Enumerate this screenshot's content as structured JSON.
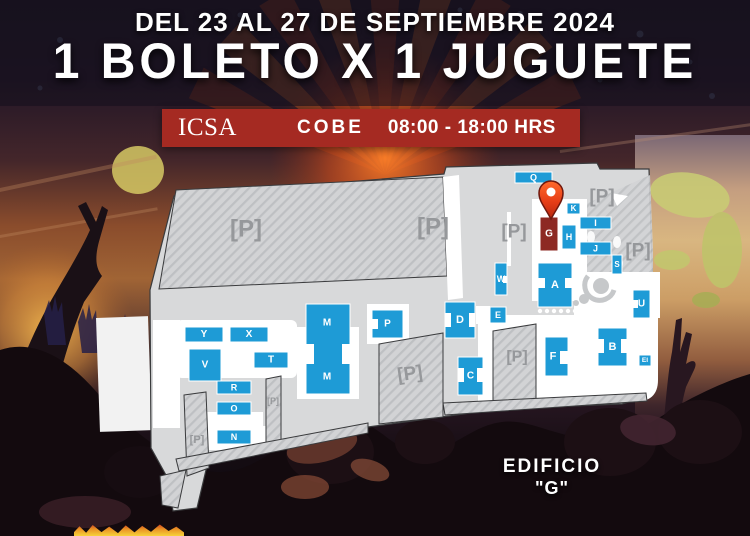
{
  "header": {
    "date_line": "DEL 23 AL 27 DE SEPTIEMBRE 2024",
    "promo_line": "1 BOLETO X 1 JUGUETE"
  },
  "banner": {
    "org": "ICSA",
    "dept": "COBE",
    "hours": "08:00 - 18:00 HRS",
    "bg_color": "#a52a22"
  },
  "callout": {
    "line1": "EDIFICIO",
    "line2": "\"G\""
  },
  "map": {
    "colors": {
      "land": "#d8d9da",
      "building": "#1e9bd6",
      "highlight": "#8d2923",
      "outline": "#3a3b3d",
      "parking_text": "#96989b",
      "pin": "#e8481f",
      "pin_dark": "#70180d"
    },
    "parking_symbol": "[P]",
    "highlighted_building": "G",
    "pin": {
      "x": 551,
      "y": 219
    },
    "buildings": [
      {
        "label": "Q",
        "x": 515,
        "y": 172,
        "w": 37,
        "h": 11,
        "fs": 9
      },
      {
        "label": "K",
        "x": 567,
        "y": 203,
        "w": 13,
        "h": 11,
        "fs": 8
      },
      {
        "label": "G",
        "x": 540,
        "y": 217,
        "w": 18,
        "h": 34,
        "fs": 10,
        "highlight": true
      },
      {
        "label": "H",
        "x": 562,
        "y": 225,
        "w": 14,
        "h": 24,
        "fs": 9
      },
      {
        "label": "I",
        "x": 580,
        "y": 217,
        "w": 31,
        "h": 12,
        "fs": 9
      },
      {
        "label": "J",
        "x": 580,
        "y": 242,
        "w": 31,
        "h": 13,
        "fs": 9
      },
      {
        "label": "S",
        "x": 612,
        "y": 255,
        "w": 10,
        "h": 19,
        "fs": 8
      },
      {
        "label": "W",
        "x": 495,
        "y": 263,
        "w": 12,
        "h": 32,
        "fs": 9,
        "cuts": [
          [
            8,
            13,
            4,
            7
          ]
        ]
      },
      {
        "label": "A",
        "x": 538,
        "y": 263,
        "w": 34,
        "h": 44,
        "fs": 11,
        "cuts": [
          [
            0,
            15,
            7,
            10
          ],
          [
            27,
            15,
            7,
            10
          ]
        ]
      },
      {
        "label": "U",
        "x": 633,
        "y": 290,
        "w": 17,
        "h": 28,
        "fs": 10,
        "cuts": [
          [
            0,
            10,
            5,
            8
          ]
        ]
      },
      {
        "label": "E",
        "x": 490,
        "y": 307,
        "w": 16,
        "h": 16,
        "fs": 9
      },
      {
        "label": "D",
        "x": 445,
        "y": 302,
        "w": 30,
        "h": 36,
        "fs": 11,
        "cuts": [
          [
            0,
            11,
            6,
            14
          ],
          [
            24,
            11,
            6,
            14
          ]
        ]
      },
      {
        "label": "P",
        "x": 372,
        "y": 310,
        "w": 31,
        "h": 28,
        "fs": 10,
        "cuts": [
          [
            0,
            9,
            6,
            10
          ]
        ]
      },
      {
        "label": "M",
        "x": 306,
        "y": 304,
        "w": 44,
        "h": 90,
        "fs": 10,
        "cuts": [
          [
            0,
            40,
            8,
            20
          ],
          [
            36,
            40,
            8,
            20
          ]
        ],
        "labels": [
          [
            21,
            19
          ],
          [
            21,
            73
          ]
        ]
      },
      {
        "label": "F",
        "x": 545,
        "y": 337,
        "w": 23,
        "h": 39,
        "fs": 11,
        "lx": 8,
        "cuts": [
          [
            15,
            14,
            8,
            13
          ]
        ]
      },
      {
        "label": "B",
        "x": 598,
        "y": 328,
        "w": 29,
        "h": 38,
        "fs": 11,
        "cuts": [
          [
            0,
            11,
            6,
            14
          ],
          [
            23,
            11,
            6,
            14
          ]
        ]
      },
      {
        "label": "C",
        "x": 458,
        "y": 357,
        "w": 25,
        "h": 38,
        "fs": 10,
        "cuts": [
          [
            0,
            11,
            6,
            14
          ],
          [
            19,
            11,
            6,
            14
          ]
        ]
      },
      {
        "label": "EI",
        "x": 639,
        "y": 355,
        "w": 12,
        "h": 11,
        "fs": 6.5
      },
      {
        "label": "Y",
        "x": 185,
        "y": 327,
        "w": 38,
        "h": 15,
        "fs": 10
      },
      {
        "label": "X",
        "x": 230,
        "y": 327,
        "w": 38,
        "h": 15,
        "fs": 10
      },
      {
        "label": "T",
        "x": 254,
        "y": 352,
        "w": 34,
        "h": 16,
        "fs": 10
      },
      {
        "label": "V",
        "x": 189,
        "y": 349,
        "w": 32,
        "h": 32,
        "fs": 10
      },
      {
        "label": "R",
        "x": 217,
        "y": 381,
        "w": 34,
        "h": 13,
        "fs": 9
      },
      {
        "label": "O",
        "x": 217,
        "y": 402,
        "w": 34,
        "h": 13,
        "fs": 9
      },
      {
        "label": "N",
        "x": 217,
        "y": 430,
        "w": 34,
        "h": 14,
        "fs": 9
      }
    ],
    "parking_labels": [
      {
        "x": 246,
        "y": 229,
        "s": 24
      },
      {
        "x": 433,
        "y": 227,
        "s": 24
      },
      {
        "x": 514,
        "y": 232,
        "s": 19
      },
      {
        "x": 602,
        "y": 197,
        "s": 19
      },
      {
        "x": 638,
        "y": 251,
        "s": 19
      },
      {
        "x": 517,
        "y": 357,
        "s": 16
      },
      {
        "x": 410,
        "y": 374,
        "s": 19,
        "rot": -8
      },
      {
        "x": 197,
        "y": 440,
        "s": 11
      },
      {
        "x": 273,
        "y": 401,
        "s": 9
      }
    ]
  }
}
